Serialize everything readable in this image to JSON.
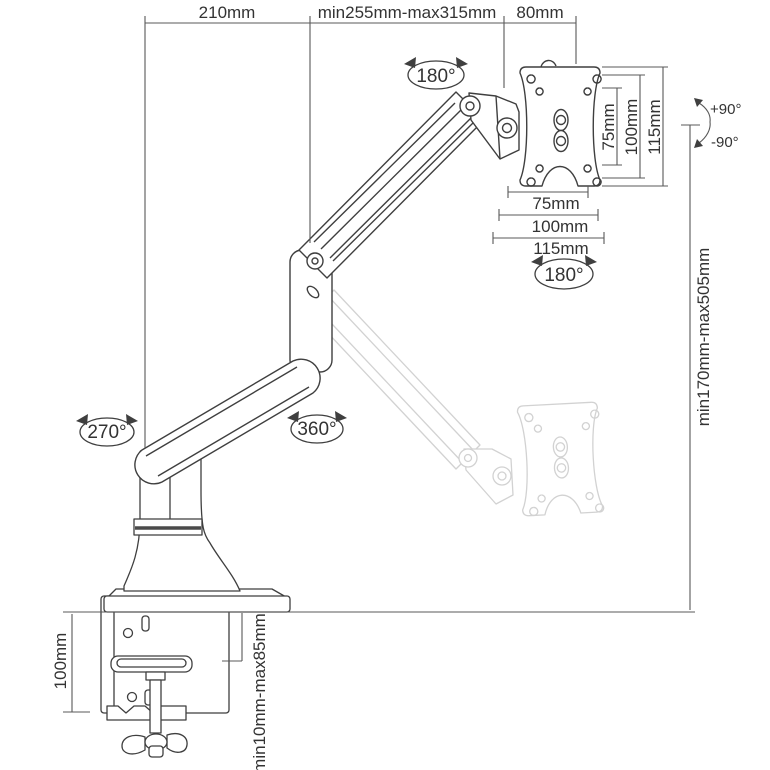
{
  "diagram": {
    "type": "technical-dimension-drawing",
    "subject": "gas-spring single monitor desk mount arm with C-clamp and VESA plate",
    "colors": {
      "background": "#ffffff",
      "main_line": "#3f3f3f",
      "dimension_line": "#585858",
      "ghost_line": "#d2d2d2",
      "text": "#333333"
    },
    "labels": {
      "dim_lower_arm": "210mm",
      "dim_upper_arm_range": "min255mm-max315mm",
      "dim_head": "80mm",
      "rot_head_swivel": "180°",
      "vesa_v_inner": "75mm",
      "vesa_v_mid": "100mm",
      "vesa_v_outer": "115mm",
      "tilt_up": "+90°",
      "tilt_down": "-90°",
      "vesa_h_inner": "75mm",
      "vesa_h_mid": "100mm",
      "vesa_h_outer": "115mm",
      "rot_plate": "180°",
      "dim_height_range": "min170mm-max505mm",
      "rot_base_swivel": "270°",
      "rot_arm_swivel": "360°",
      "dim_clamp_height": "100mm",
      "dim_desk_thickness": "min10mm-max85mm"
    }
  }
}
